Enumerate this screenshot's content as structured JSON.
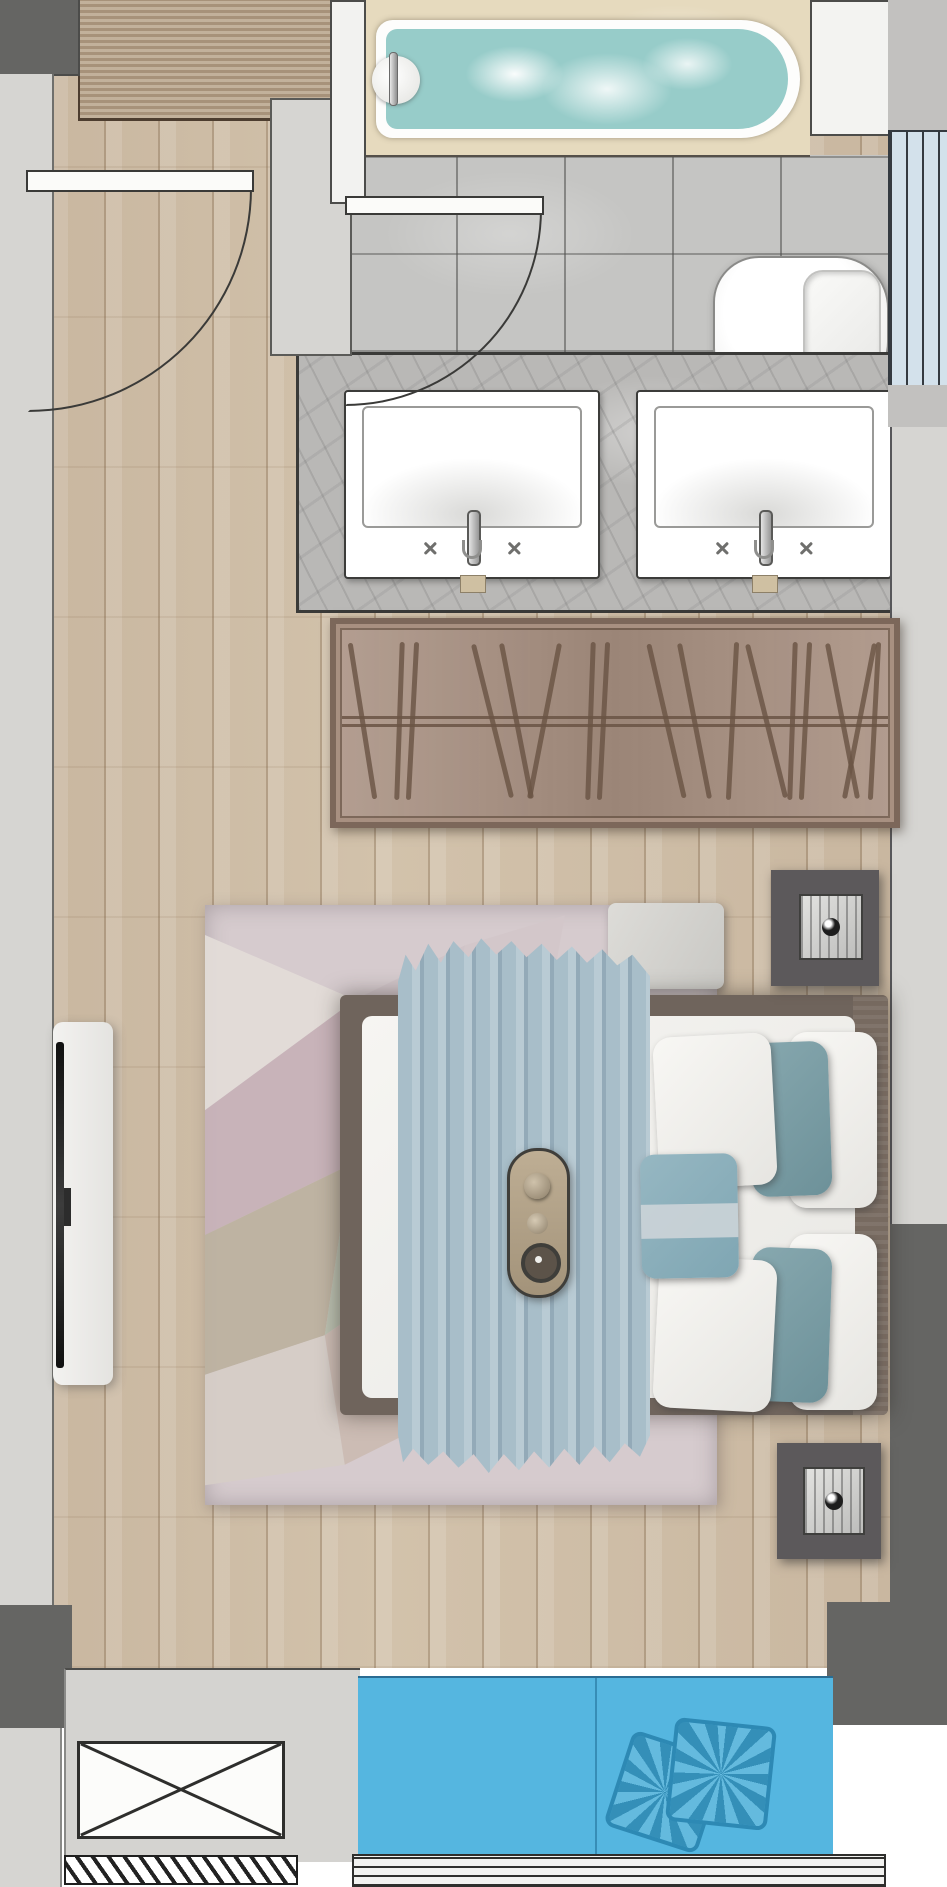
{
  "floorplan": {
    "type": "apartment-bedroom-suite-top-view",
    "rooms": [
      "entry",
      "bathroom",
      "bedroom",
      "balcony"
    ],
    "fixtures": [
      "bathtub",
      "toilet",
      "double-vanity",
      "wardrobe",
      "double-bed",
      "nightstands",
      "table-lamps",
      "tv-console",
      "rug",
      "balcony-cushions",
      "ac-platform"
    ],
    "colors": {
      "wood": "#c9b7a0",
      "wood-entry": "#b7a38a",
      "tile": "#c5c5c3",
      "wall-light": "#d6d5d2",
      "wall-mid": "#c2c1bf",
      "wall-dark": "#656563",
      "deck": "#e6dabe",
      "water": "#97ccc9",
      "pane": "#d3e1eb",
      "counter": "#b9b8b6",
      "wardrobe": "#a89081",
      "wardrobe-border": "#7c675a",
      "hanger": "#6a5444",
      "bedframe": "#6f645c",
      "duvet": "#a8bec9",
      "accent-band": "#ccd4d8",
      "nightstand": "#5c595b",
      "rug": "#d6cbce",
      "blue": "#55b6e0",
      "blue-pillow": "#4fb0da",
      "blue-border": "#2d89b4"
    },
    "wardrobe": {
      "hangers": [
        {
          "x": 18,
          "tilt": -9
        },
        {
          "x": 55,
          "tilt": 2
        },
        {
          "x": 68,
          "tilt": 3
        },
        {
          "x": 148,
          "tilt": -14
        },
        {
          "x": 172,
          "tilt": -11
        },
        {
          "x": 200,
          "tilt": 11
        },
        {
          "x": 246,
          "tilt": 2
        },
        {
          "x": 259,
          "tilt": 3
        },
        {
          "x": 322,
          "tilt": -13
        },
        {
          "x": 350,
          "tilt": -11
        },
        {
          "x": 388,
          "tilt": 3
        },
        {
          "x": 422,
          "tilt": -14
        },
        {
          "x": 448,
          "tilt": 2
        },
        {
          "x": 461,
          "tilt": 3
        },
        {
          "x": 498,
          "tilt": -11
        },
        {
          "x": 515,
          "tilt": 11
        },
        {
          "x": 530,
          "tilt": 3
        }
      ]
    },
    "rug": {
      "triangles": [
        {
          "pts": "0% 5%, 29.3% 15.8%, 0% 34.2%",
          "color": "#e3dcd8"
        },
        {
          "pts": "0% 34.2%, 29.3% 15.8%, 28.3% 43.3%, 0% 55%",
          "color": "#c7b1b7"
        },
        {
          "pts": "0% 55%, 28.3% 43.3%, 23.4% 71.7%, 0% 78.3%",
          "color": "#bcb19e"
        },
        {
          "pts": "0% 78.3%, 23.4% 71.7%, 27.3% 93.3%, 0% 96.7%",
          "color": "#d6cdc7"
        },
        {
          "pts": "29.3% 15.8%, 50.8% 6.7%, 44.9% 30%, 28.3% 43.3%",
          "color": "#cfc3c8"
        },
        {
          "pts": "28.3% 43.3%, 44.9% 30%, 48.8% 56.7%, 23.4% 71.7%",
          "color": "#b8bfae"
        },
        {
          "pts": "23.4% 71.7%, 48.8% 56.7%, 50.8% 83.3%, 27.3% 93.3%",
          "color": "#cbbbb2"
        },
        {
          "pts": "50.8% 6.7%, 70.3% 1.7%, 66.4% 20%, 44.9% 30%",
          "color": "#d3c7ca"
        }
      ]
    },
    "balcony": {
      "cushion_count": 2
    },
    "bed": {
      "pillow_groups": 2,
      "accent_pillows": 1,
      "tray": "breakfast-tray"
    }
  }
}
